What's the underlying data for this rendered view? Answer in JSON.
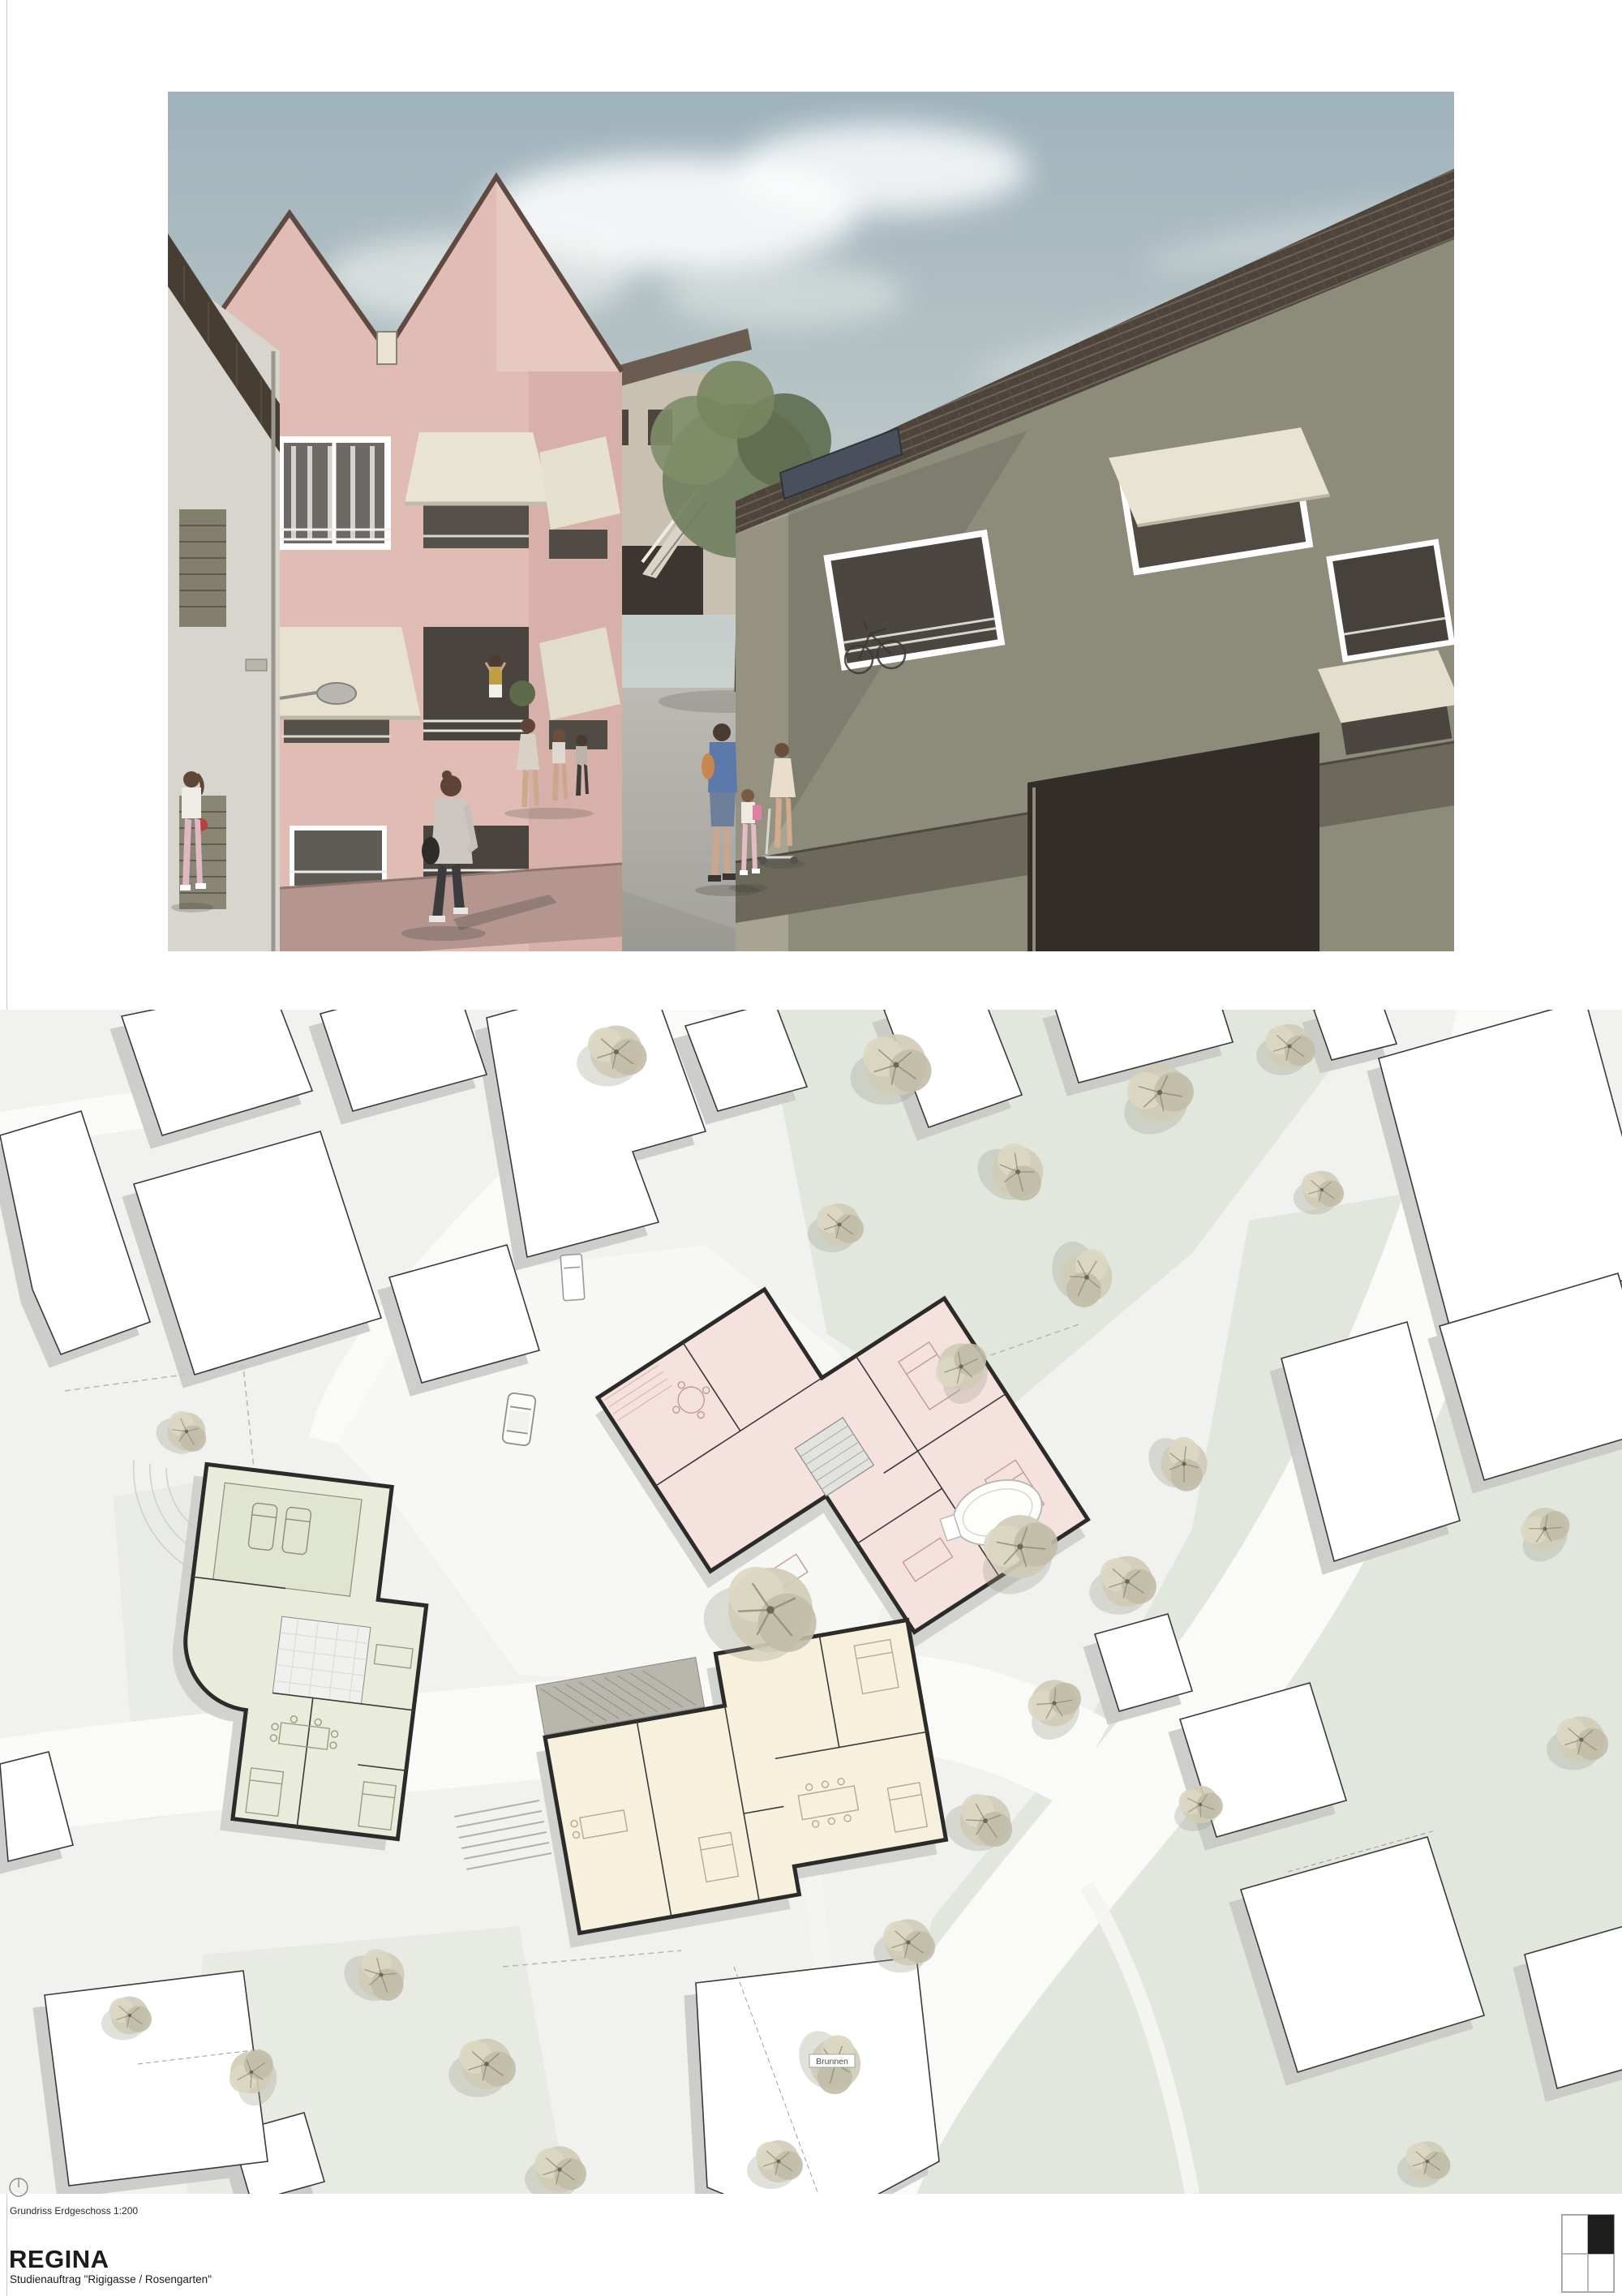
{
  "sheet": {
    "title": "REGINA",
    "subtitle": "Studienauftrag \"Rigigasse / Rosengarten\""
  },
  "plan": {
    "caption": "Grundriss Erdgeschoss 1:200",
    "scale": "1:200",
    "label_brunnen": "Brunnen"
  },
  "icons": {
    "north_arrow": "north-arrow-icon",
    "page_indicator": "page-grid-icon"
  },
  "page_indicator": {
    "rows": 2,
    "cols": 2,
    "active_cell": "top-right"
  },
  "colors": {
    "paper": "#ffffff",
    "plan_ground": "#f1f1ef",
    "plan_green": "#e2e7de",
    "plan_building_fill": "#ffffff",
    "plan_shadow": "#c7c7c5",
    "plan_pink_flat": "#f5e2df",
    "plan_sage_flat": "#e9ecdb",
    "plan_cream_flat": "#f6f0dc",
    "render_sky": "#a8bcc4",
    "render_pink_facade": "#e0bcb4",
    "render_pink_plinth": "#b5968e",
    "render_green_facade": "#8d8b79",
    "render_awning": "#e9e3d2",
    "render_ground": "#aaa9a3",
    "indicator_active": "#1e1e1c"
  }
}
